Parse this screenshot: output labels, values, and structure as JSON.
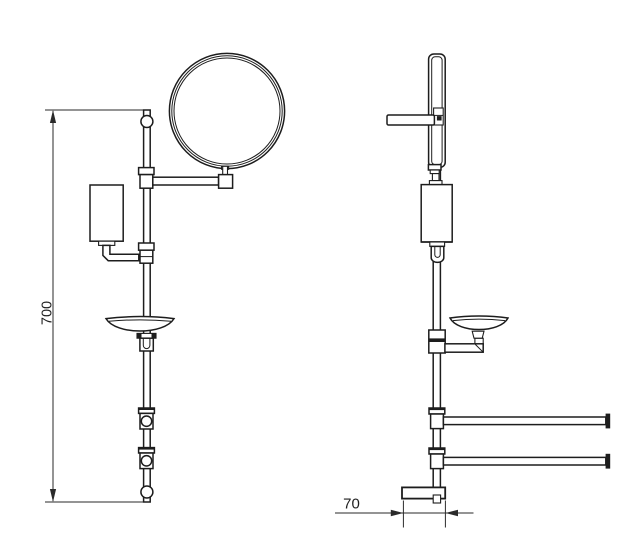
{
  "drawing": {
    "type": "technical-dimension-drawing",
    "subject": "wall-mounted bathroom accessory column, front and side views",
    "dimensions": {
      "height": {
        "label": "700",
        "orientation": "vertical"
      },
      "base_depth": {
        "label": "70",
        "orientation": "horizontal"
      }
    },
    "colors": {
      "line": "#1d1d1d",
      "dimension_line": "#2a2a2a",
      "text": "#1f1f1f",
      "background": "#ffffff"
    }
  }
}
